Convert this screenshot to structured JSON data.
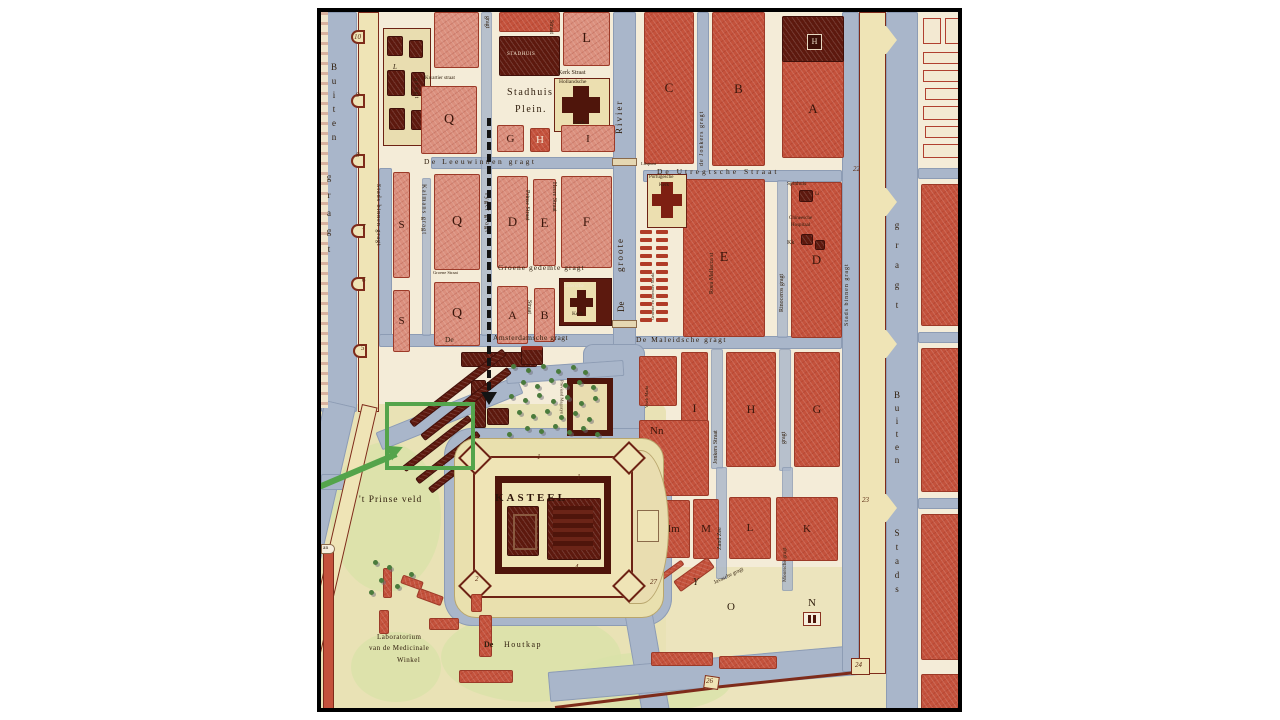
{
  "labels": {
    "blocks": {
      "l_top": "L",
      "q_top": "Q",
      "g": "G",
      "h": "H",
      "i": "I",
      "c": "C",
      "b": "B",
      "a": "A",
      "s1": "S",
      "q_mid": "Q",
      "d": "D",
      "e": "E",
      "f": "F",
      "e_big": "E",
      "d_big": "D",
      "s2": "S",
      "q_low": "Q",
      "a2": "A",
      "b2": "B",
      "i2": "I",
      "h2": "H",
      "g2": "G",
      "nn": "Nn",
      "mm": "Mm",
      "m": "M",
      "l2": "L",
      "k": "K",
      "y": "Y",
      "o": "O",
      "n": "N",
      "li": "Li",
      "kk": "Kk",
      "l_small": "L",
      "h_icon": "H"
    },
    "streets": {
      "buiten_w": "Buiten",
      "gragt_w": "gragt",
      "stads_binnen_w": "Stads binnen gragt",
      "gragt_compound": "gragt",
      "kaimans": "Kaimans gragt",
      "tyger": "Tyger gragt",
      "prinse_straat": "Prinse Straat",
      "straat_lower": "Straat",
      "heere": "Heere Straat",
      "groene_straat": "Groene Straat",
      "groene_gedemte": "Groene gedemte gragt",
      "leeuwinnen": "De Leeuwinnen gragt",
      "kwartier": "Kwartier straat",
      "kerk_straat": "Kerk Straat",
      "straat_top": "Straat",
      "gragt_top": "gragt",
      "de": "De",
      "amsterdamsche": "Amsterdamsche gragt",
      "maleidsche": "De Maleidsche gragt",
      "rivier_de": "De",
      "rivier_groote": "groote",
      "rivier": "Rivier",
      "jonkers_gragt": "de Jonkers gragt",
      "lilspunt": "Lilspunt",
      "utregtsche": "De Utregtsche Straat",
      "roea": "Roea Mallacca st",
      "rinoceros": "Rinoceros gragt",
      "stads_binnen_e": "Stads binnen gragt",
      "gragt_e": "gragt",
      "buiten_e": "Buiten",
      "stads_e": "Stads",
      "jonkers_straat": "Jonkers Straat",
      "gragt_hg": "gragt",
      "zand_zee": "Zand Zee",
      "moorsche": "Moorsche gragt",
      "javasche": "Javasche gragt",
      "visch_markt": "Visch Markt",
      "proviand": "Proviand Magazyn",
      "groente": "Groente en hoender Markt"
    },
    "landmarks": {
      "stadhuis_plein_1": "Stadhuis",
      "stadhuis_plein_2": "Plein.",
      "stadhuis": "STADHUIS",
      "hollandsche": "Hollandsche",
      "kerk1": "Kerk",
      "lutersche": "Lutersche",
      "kerk2": "Kerk",
      "portugesche": "Portugesche",
      "kerk3": "Kerk",
      "spinhuis": "Spinhuis",
      "chineesche": "Chineesche",
      "hospitaal": "Hospitaal",
      "kasteel": "KASTEEL",
      "prinse_veld": "'t Prinse veld",
      "lab1": "Laboratorium",
      "lab2": "van de Medicinale",
      "lab3": "Winkel",
      "houtkap_de": "De",
      "houtkap": "Houtkap",
      "an": "an"
    },
    "numbers": {
      "w10": "10",
      "w9": "9",
      "w8": "8",
      "w7": "7",
      "w6": "6",
      "w5": "5",
      "e22": "22",
      "e23": "23",
      "e24": "24",
      "s26": "26",
      "s27": "27",
      "k1": "1",
      "k2": "2",
      "k4": "4",
      "k1b": "1"
    }
  },
  "annotations": {
    "highlight_color": "#54a44b",
    "dashed_arrow_color": "#141414"
  }
}
